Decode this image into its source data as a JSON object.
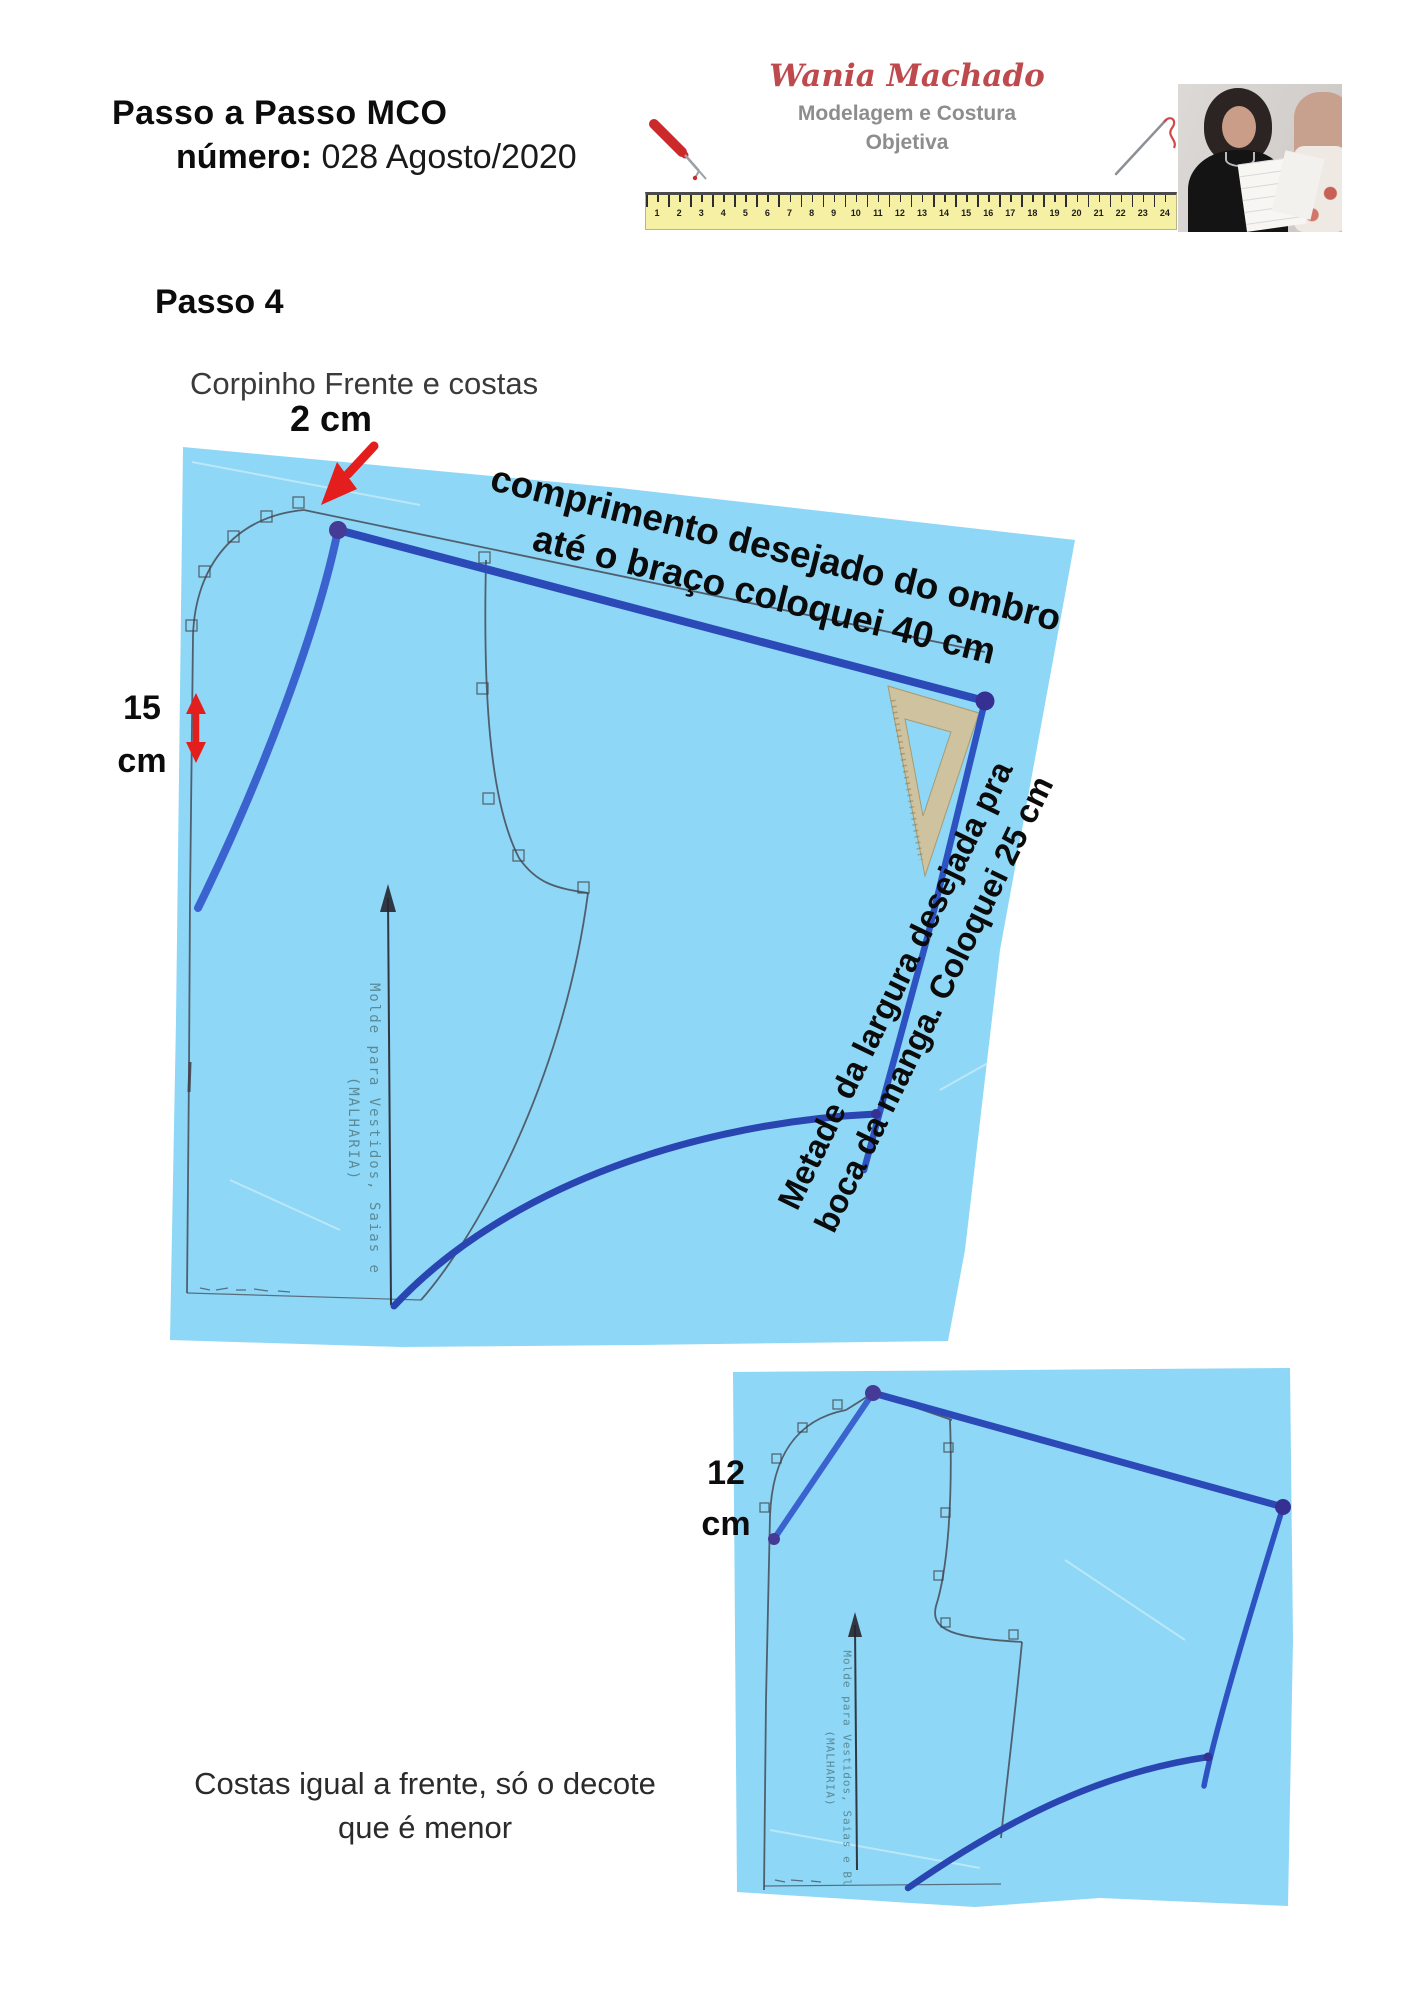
{
  "header": {
    "title": "Passo a Passo MCO",
    "number_label": "número:",
    "number_value": "028 Agosto/2020"
  },
  "logo": {
    "name": "Wania Machado",
    "subtitle1": "Modelagem e Costura",
    "subtitle2": "Objetiva",
    "ruler_numbers": [
      "1",
      "2",
      "3",
      "4",
      "5",
      "6",
      "7",
      "8",
      "9",
      "10",
      "11",
      "12",
      "13",
      "14",
      "15",
      "16",
      "17",
      "18",
      "19",
      "20",
      "21",
      "22",
      "23",
      "24"
    ]
  },
  "step": {
    "title": "Passo 4",
    "subtitle": "Corpinho Frente e costas"
  },
  "labels": {
    "two_cm": "2 cm",
    "fifteen": [
      "15",
      "cm"
    ],
    "twelve": [
      "12",
      "cm"
    ],
    "rot1": [
      "comprimento desejado  do ombro",
      "até o braço coloquei 40 cm"
    ],
    "rot2": [
      "Metade da largura desejada pra",
      "boca da manga. Coloquei 25 cm"
    ]
  },
  "caption": [
    "Costas igual a frente, só o decote",
    "que é menor"
  ],
  "stamps": {
    "front": [
      "Molde para Vestidos, Saias e",
      "(MALHARIA)"
    ],
    "back": [
      "Molde para Vestidos, Saias e Bl",
      "(MALHARIA)"
    ]
  },
  "colors": {
    "paper": "#8ed7f6",
    "pencil": "#41414b",
    "marker": "#2b4ab8",
    "marker-light": "#3a63cf",
    "marker-mid": "#2d52c2",
    "marker-curve": "#2945b2",
    "dot": "#453b96",
    "dot2": "#363093",
    "red": "#e41d1d",
    "brand": "#bf4a4e",
    "gray": "#8d8d8d",
    "ruler": "#f5f0a3",
    "stamp": "#4f7d88"
  }
}
